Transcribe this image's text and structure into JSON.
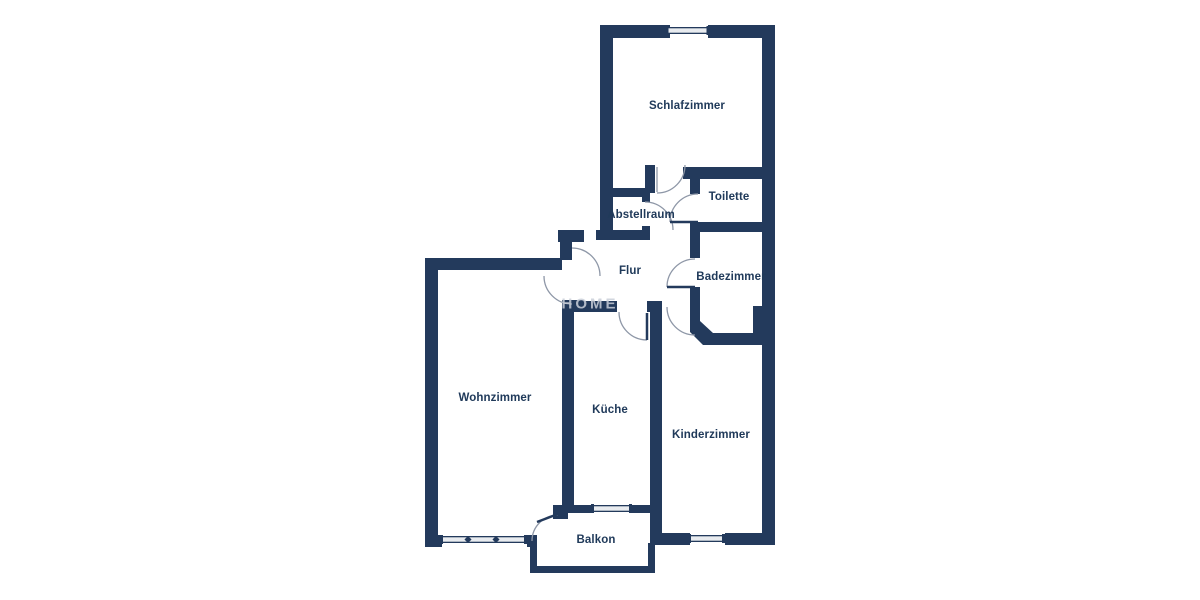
{
  "floorplan": {
    "rooms": [
      {
        "name": "schlafzimmer",
        "label": "Schlafzimmer"
      },
      {
        "name": "toilette",
        "label": "Toilette"
      },
      {
        "name": "abstellraum",
        "label": "Abstellraum"
      },
      {
        "name": "flur",
        "label": "Flur"
      },
      {
        "name": "badezimmer",
        "label": "Badezimmer"
      },
      {
        "name": "wohnzimmer",
        "label": "Wohnzimmer"
      },
      {
        "name": "kueche",
        "label": "Küche"
      },
      {
        "name": "kinderzimmer",
        "label": "Kinderzimmer"
      },
      {
        "name": "balkon",
        "label": "Balkon"
      }
    ],
    "watermark": "HOME",
    "colors": {
      "wall": "#233a5c",
      "label_text": "#203a5a",
      "door_arc": "#8e97a7",
      "window_fill": "#e8ebef",
      "background": "#ffffff"
    }
  }
}
